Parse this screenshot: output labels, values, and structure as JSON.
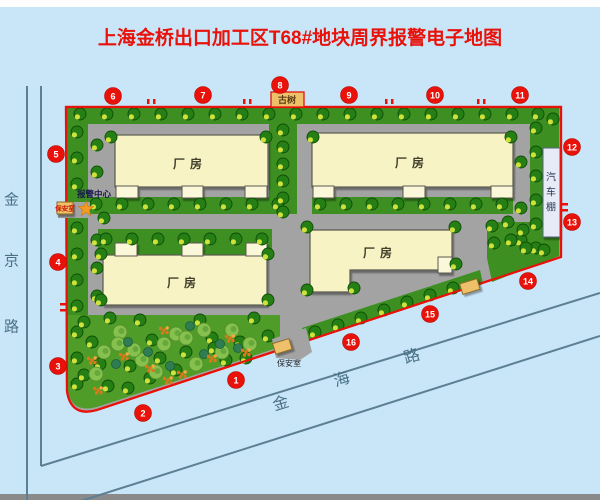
{
  "title": "上海金桥出口加工区T68#地块周界报警电子地图",
  "roads": {
    "left": "金京路",
    "bottom": "金海路"
  },
  "labels": {
    "factory": "厂房",
    "car_shed": "汽车棚",
    "ancient_tree": "古树",
    "alarm_center": "报警中心",
    "guard_room_west": "保安室",
    "guard_room_south": "保安室"
  },
  "zones": [
    "1",
    "2",
    "3",
    "4",
    "5",
    "6",
    "7",
    "8",
    "9",
    "10",
    "11",
    "12",
    "13",
    "14",
    "15",
    "16"
  ],
  "colors": {
    "background": "#c9e6f8",
    "accent_red": "#e8120a",
    "road_gray": "#a3a3a3",
    "band_green": "#3c8f20",
    "garden_green": "#4f9c28",
    "building_cream": "#f8f3c5",
    "entrance_cream": "#fbf7d9",
    "building_text": "#403f2c",
    "tree_dark": "#267f14",
    "tree_edge": "#0f4d08",
    "tree_highlight": "#cfe23c",
    "bush_green": "#86c14f",
    "bush_edge": "#558f2c",
    "teal_green": "#2f7d52",
    "flower_orange": "#e0761a",
    "flower_light": "#f2a93e",
    "tan_box": "#eec06a",
    "tan_edge": "#8a6a20",
    "star_orange": "#f59b22",
    "shed_fill": "#e6ebf7",
    "shed_edge": "#55657a",
    "shed_text": "#2c3a55",
    "outside_line": "#5c7f94",
    "road_text": "#4a7086",
    "alarm_text": "#15154a",
    "guard_text_red": "#cc1a00",
    "south_text": "#222222",
    "tree_box_text": "#5a3c12"
  }
}
